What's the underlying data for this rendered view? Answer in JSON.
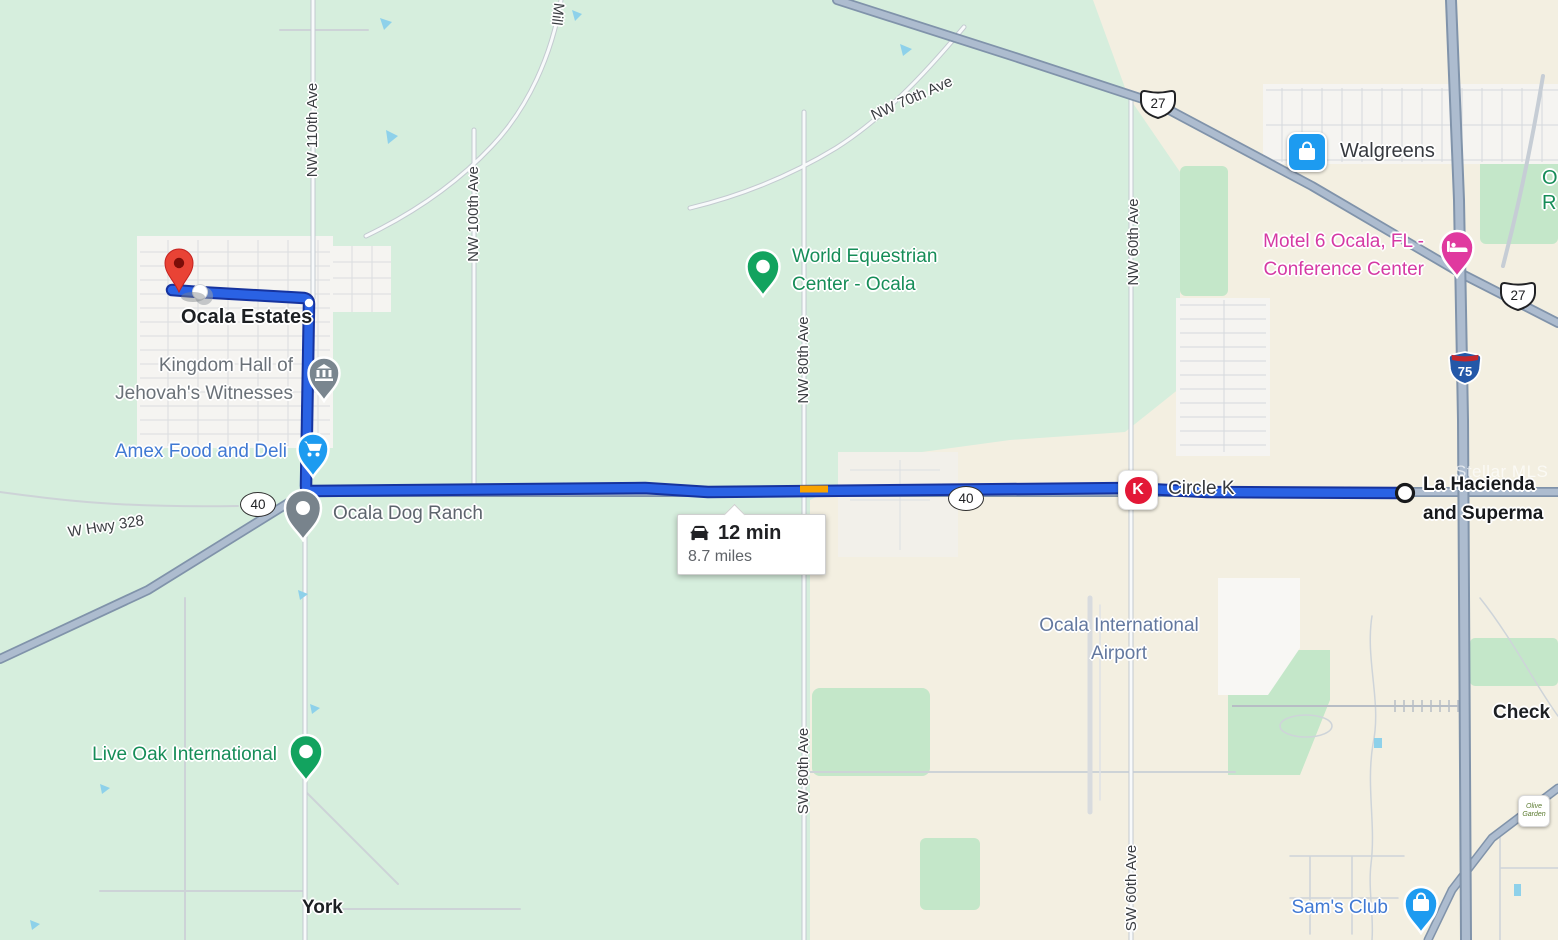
{
  "watermark": "Stellar MLS",
  "tooltip": {
    "duration": "12 min",
    "distance": "8.7 miles"
  },
  "shields": {
    "fl40": "40",
    "us27": "27",
    "i75": "75"
  },
  "road_labels": {
    "nw_110th": "NW 110th Ave",
    "nw_100th": "NW 100th Ave",
    "mill": "Mill",
    "nw_70th": "NW 70th Ave",
    "nw_80th": "NW 80th Ave",
    "nw_60th": "NW 60th Ave",
    "sw_80th": "SW 80th Ave",
    "sw_60th": "SW 60th Ave",
    "w_hwy_328": "W Hwy 328"
  },
  "places": {
    "ocala_estates": "Ocala Estates",
    "kingdom_hall_line1": "Kingdom Hall of",
    "kingdom_hall_line2": "Jehovah's Witnesses",
    "amex_food_deli": "Amex Food and Deli",
    "ocala_dog_ranch": "Ocala Dog Ranch",
    "world_equestrian_line1": "World Equestrian",
    "world_equestrian_line2": "Center - Ocala",
    "walgreens": "Walgreens",
    "motel6_line1": "Motel 6 Ocala, FL -",
    "motel6_line2": "Conference Center",
    "circle_k": "Circle K",
    "circle_k_logo_letter": "K",
    "la_hacienda_line1": "La Hacienda",
    "la_hacienda_line2": "and Superma",
    "airport_line1": "Ocala International",
    "airport_line2": "Airport",
    "live_oak": "Live Oak International",
    "sams_club": "Sam's Club",
    "york": "York",
    "checkers_partial": "Check",
    "green_label_partial_line1": "O",
    "green_label_partial_line2": "R",
    "olive_garden_line1": "Olive",
    "olive_garden_line2": "Garden"
  },
  "colors": {
    "route_fill": "#2a62e4",
    "route_casing": "#16339e",
    "traffic_orange": "#f9a300",
    "pin_red": "#e94335",
    "pin_blue": "#1d9bf0",
    "pin_green": "#12a35f",
    "pin_gray": "#7a868f",
    "pin_pink": "#e0399f",
    "label_blue": "#4079d3",
    "label_green": "#168d58",
    "label_pink": "#d53aa4",
    "label_airport": "#63789f",
    "circle_k_red": "#e31837",
    "map_green": "#d6eedd",
    "map_beige": "#f3efe1"
  }
}
